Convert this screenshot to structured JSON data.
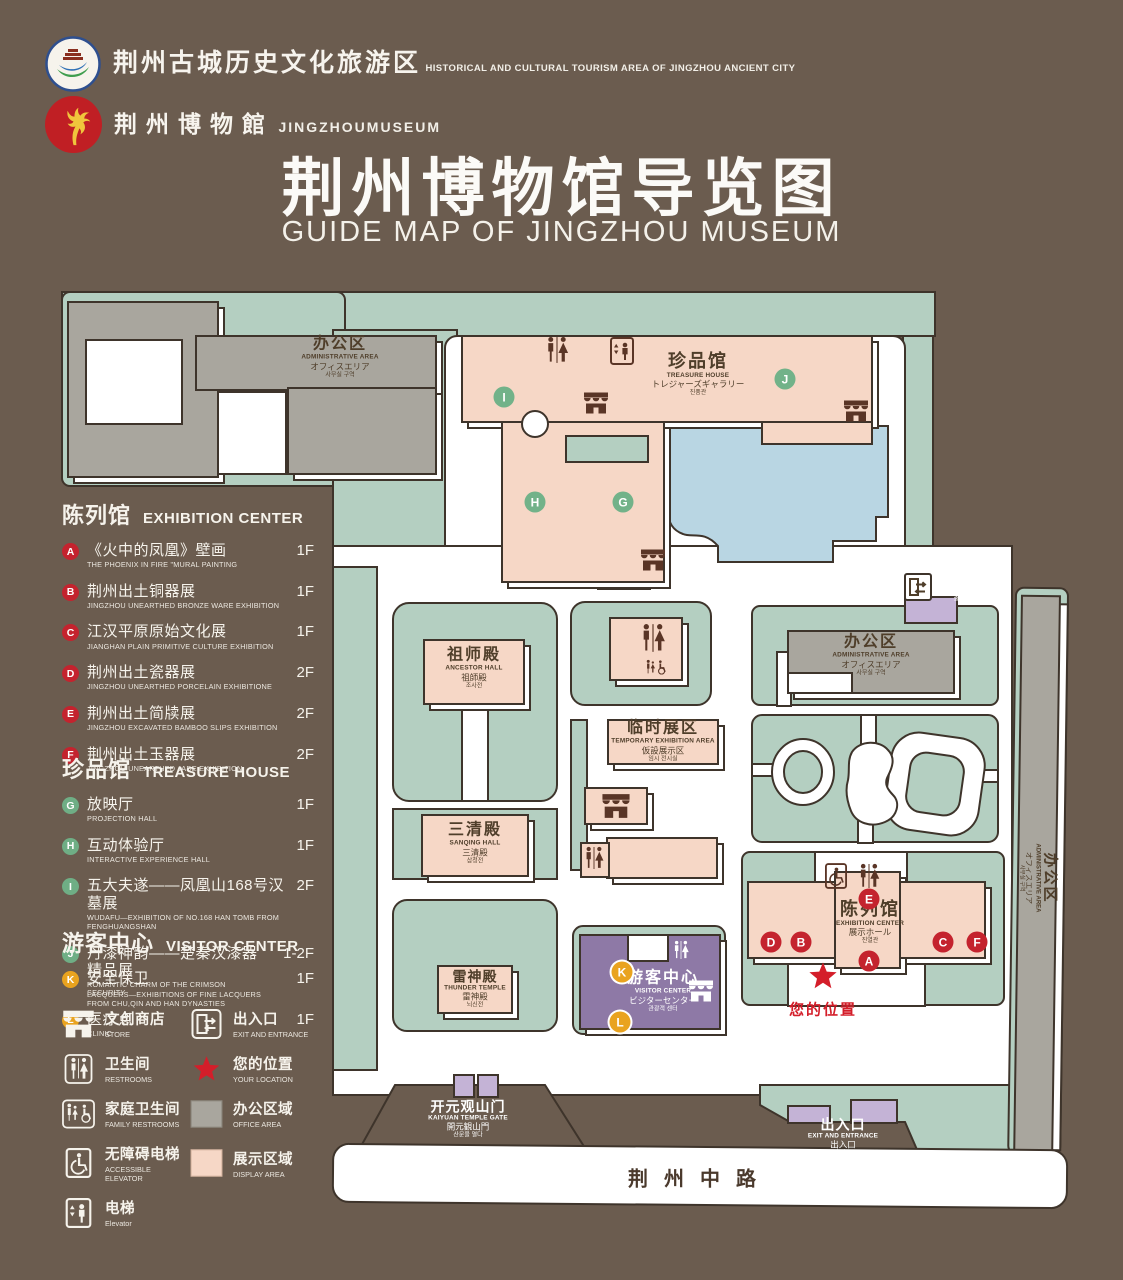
{
  "colors": {
    "background": "#6b5c4f",
    "lawn": "#b4cfc1",
    "display_area": "#f6d7c6",
    "office_area": "#a9a69e",
    "lake": "#b9d6e3",
    "visitor_purple": "#8e79a6",
    "entrance_purple": "#c4b3d6",
    "marker_red": "#c4232e",
    "marker_green": "#72b289",
    "marker_orange": "#e9a31f",
    "accent_red": "#d41e2a",
    "outline": "#3e342b"
  },
  "header": {
    "org_logo": {
      "zh": "荆州古城历史文化旅游区",
      "en": "HISTORICAL AND CULTURAL TOURISM AREA OF JINGZHOU ANCIENT CITY"
    },
    "museum_logo": {
      "zh": "荆州博物館",
      "en": "JINGZHOUMUSEUM"
    },
    "title_zh": "荆州博物馆导览图",
    "title_en": "GUIDE MAP OF JINGZHOU MUSEUM"
  },
  "legend": {
    "sections": [
      {
        "zh": "陈列馆",
        "en": "EXHIBITION CENTER",
        "items": [
          {
            "letter": "A",
            "zh": "《火中的凤凰》壁画",
            "en": "THE PHOENIX IN FIRE \"MURAL PAINTING",
            "floor": "1F"
          },
          {
            "letter": "B",
            "zh": "荆州出土铜器展",
            "en": "JINGZHOU UNEARTHED BRONZE WARE EXHIBITION",
            "floor": "1F"
          },
          {
            "letter": "C",
            "zh": "江汉平原原始文化展",
            "en": "JIANGHAN PLAIN PRIMITIVE CULTURE EXHIBITION",
            "floor": "1F"
          },
          {
            "letter": "D",
            "zh": "荆州出土瓷器展",
            "en": "JINGZHOU UNEARTHED PORCELAIN EXHIBITIONE",
            "floor": "2F"
          },
          {
            "letter": "E",
            "zh": "荆州出土简牍展",
            "en": "JINGZHOU EXCAVATED BAMBOO SLIPS EXHIBITION",
            "floor": "2F"
          },
          {
            "letter": "F",
            "zh": "荆州出土玉器展",
            "en": "JINGZHOU UNEARTHED JADE EXHIBITION",
            "floor": "2F"
          }
        ]
      },
      {
        "zh": "珍品馆",
        "en": "TREASURE HOUSE",
        "items": [
          {
            "letter": "G",
            "zh": "放映厅",
            "en": "PROJECTION HALL",
            "floor": "1F"
          },
          {
            "letter": "H",
            "zh": "互动体验厅",
            "en": "INTERACTIVE EXPERIENCE HALL",
            "floor": "1F"
          },
          {
            "letter": "I",
            "zh": "五大夫遂——凤凰山168号汉墓展",
            "en": "WUDAFU—EXHIBITION OF NO.168 HAN TOMB FROM FENGHUANGSHAN",
            "floor": "2F"
          },
          {
            "letter": "J",
            "zh": "丹漆神韵——楚秦汉漆器精品展",
            "en": "ROMANTIC CHARM OF THE CRIMSON LACQUERS—EXHIBITIONS OF FINE LACQUERS FROM CHU,QIN AND HAN DYNASTIES",
            "floor": "1-2F"
          }
        ]
      },
      {
        "zh": "游客中心",
        "en": "VISITOR CENTER",
        "items": [
          {
            "letter": "K",
            "zh": "安全保卫",
            "en": "SECURITY",
            "floor": "1F"
          },
          {
            "letter": "L",
            "zh": "医疗点",
            "en": "CLINIC",
            "floor": "1F"
          }
        ]
      }
    ],
    "symbols": [
      {
        "icon": "store",
        "zh": "文创商店",
        "en": "STORE"
      },
      {
        "icon": "exitdoor",
        "zh": "出入口",
        "en": "EXIT AND ENTRANCE"
      },
      {
        "icon": "restroom",
        "zh": "卫生间",
        "en": "RESTROOMS"
      },
      {
        "icon": "star",
        "zh": "您的位置",
        "en": "YOUR LOCATION"
      },
      {
        "icon": "family",
        "zh": "家庭卫生间",
        "en": "FAMILY RESTROOMS"
      },
      {
        "icon": "swatch-office",
        "zh": "办公区域",
        "en": "OFFICE AREA"
      },
      {
        "icon": "accessible",
        "zh": "无障碍电梯",
        "en": "ACCESSIBLE ELEVATOR"
      },
      {
        "icon": "swatch-display",
        "zh": "展示区域",
        "en": "DISPLAY AREA"
      },
      {
        "icon": "elevator",
        "zh": "电梯",
        "en": "Elevator"
      }
    ]
  },
  "map": {
    "labels": {
      "admin": {
        "zh": "办公区",
        "en": "ADMINISTRATIVE AREA",
        "jp": "オフィスエリア",
        "kr": "사무실 구역"
      },
      "treasure_house": {
        "zh": "珍品馆",
        "en": "TREASURE HOUSE",
        "jp": "トレジャーズギャラリー",
        "kr": "진품관"
      },
      "exit": {
        "zh": "出入口",
        "en": "EXIT AND ENTRANCE",
        "jp": "出入口",
        "kr": "출입구"
      },
      "ancestor_hall": {
        "zh": "祖师殿",
        "en": "ANCESTOR HALL",
        "jp": "祖師殿",
        "kr": "조사전"
      },
      "sanqing_hall": {
        "zh": "三清殿",
        "en": "SANQING HALL",
        "jp": "三清殿",
        "kr": "삼청전"
      },
      "thunder_temple": {
        "zh": "雷神殿",
        "en": "THUNDER TEMPLE",
        "jp": "雷神殿",
        "kr": "뇌신전"
      },
      "temp_exhibition": {
        "zh": "临时展区",
        "en": "TEMPORARY EXHIBITION AREA",
        "jp": "仮設展示区",
        "kr": "임시 전시실"
      },
      "exhibition_center": {
        "zh": "陈列馆",
        "en": "EXHIBITION CENTER",
        "jp": "展示ホール",
        "kr": "진열관"
      },
      "visitor_center": {
        "zh": "游客中心",
        "en": "VISITOR CENTER",
        "jp": "ビジターセンター",
        "kr": "관광객 센터"
      },
      "kaiyuan_gate": {
        "zh": "开元观山门",
        "en": "KAIYUAN TEMPLE GATE",
        "jp": "開元観山門",
        "kr": "산문을 열다"
      },
      "road": "荆州中路",
      "your_location": "您的位置"
    },
    "markers": [
      "A",
      "B",
      "C",
      "D",
      "E",
      "F",
      "G",
      "H",
      "I",
      "J",
      "K",
      "L"
    ]
  }
}
